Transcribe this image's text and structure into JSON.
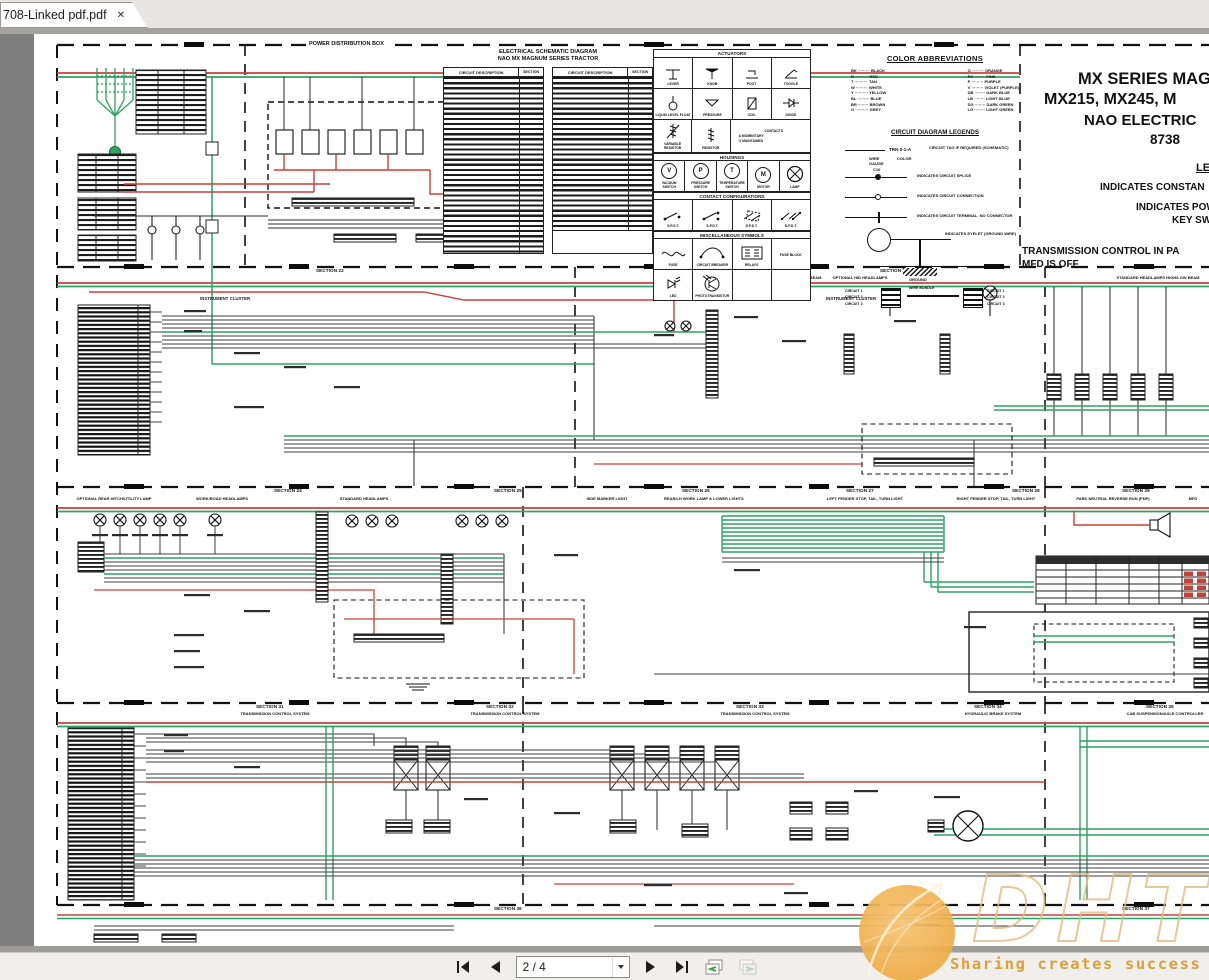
{
  "window": {
    "tab_title": "708-Linked pdf.pdf",
    "close_glyph": "✕"
  },
  "toolbar": {
    "page_display": "2 / 4"
  },
  "watermark": {
    "brand": "DHT",
    "slogan": "Sharing creates success"
  },
  "header_tables": {
    "title1": "ELECTRICAL SCHEMATIC DIAGRAM",
    "title2": "NAO MX MAGNUM SERIES TRACTOR",
    "col_circuit": "CIRCUIT DESCRIPTION",
    "col_section": "SECTION"
  },
  "symbols": {
    "actuators_title": "ACTUATORS",
    "housings_title": "HOUSINGS",
    "contacts_title": "CONTACT CONFIGURATIONS",
    "misc_title": "MISCELLANEOUS SYMBOLS",
    "lever": "LEVER",
    "knob": "KNOB",
    "foot": "FOOT",
    "toggle": "TOGGLE",
    "liquid": "LIQUID LEVEL FLOAT",
    "pressure": "PRESSURE",
    "coil": "COIL",
    "diode": "DIODE",
    "var_resistor": "VARIABLE RESISTOR",
    "resistor": "RESISTOR",
    "contacts_label": "CONTACTS",
    "momentary": "A   MOMENTARY",
    "maintained": "O   MAINTAINED",
    "housing_letters": [
      "V",
      "P",
      "T",
      "M"
    ],
    "vacuum": "VACUUM SWITCH",
    "press_switch": "PRESSURE SWITCH",
    "temp_switch": "TEMPERATURE SWITCH",
    "motor": "MOTOR",
    "lamp": "LAMP",
    "spst": "S.P.S.T.",
    "spdt": "S.P.D.T.",
    "dpst": "D.P.S.T.",
    "dpdt": "D.P.D.T.",
    "fuse": "FUSE",
    "breaker": "CIRCUIT BREAKER",
    "relays": "RELAYS",
    "fuse_block": "FUSE BLOCK",
    "led": "LED",
    "photo": "PHOTOTRANSISTOR"
  },
  "colors": {
    "title": "COLOR ABBREVIATIONS",
    "left": "BK ········· BLACK\nR ·········· RED\nT ·········· TAN\nW ········· WHITE\nY ·········· YELLOW\nBL ········· BLUE\nBR ········ BROWN\nG ·········· GREY",
    "right": "O ········· ORANGE\nPK ········ PINK\nP ········· PURPLE\nV ········· VIOLET (PURPLE)\nDB ········ DARK BLUE\nLB ········ LIGHT BLUE\nDG ········ DARK GREEN\nLG ········ LIGHT GREEN",
    "legends_title": "CIRCUIT DIAGRAM LEGENDS",
    "tag_id": "TRN 0-1-A",
    "tag_wire": "WIRE\nGAUGE",
    "tag_color": "COLOR",
    "tag_note": "CIRCUIT TAG IF REQUIRED (SCHEMATIC)",
    "splice_id": "C10",
    "legend1": "INDICATES CIRCUIT SPLICE",
    "legend2": "INDICATES CIRCUIT CONNECTION",
    "legend3": "INDICATES CIRCUIT TERMINAL, NO CONNECTOR",
    "legend4": "INDICATES EYELET (GROUND WIRE)",
    "ground": "GROUND",
    "conn_left": "CIRCUIT 1\nCIRCUIT 2\nCIRCUIT 3",
    "conn_right": "CIRCUIT 1\nCIRCUIT 2\nCIRCUIT 3",
    "conn_mid": "WIRE BUNDLE"
  },
  "title_block": {
    "l1": "MX SERIES MAG",
    "l2": "MX215, MX245, M",
    "l3": "NAO ELECTRIC",
    "l4": "8738",
    "legend": "LEGE",
    "c1": "INDICATES CONSTAN",
    "c2": "INDICATES POW",
    "c3": "KEY SWI",
    "c4": "TRANSMISSION CONTROL IN PA",
    "c5": "MFD IS OFF"
  },
  "sections": {
    "power_box": "POWER DISTRIBUTION BOX",
    "cluster": "INSTRUMENT CLUSTER",
    "d2": [
      "SECTION 22",
      "SECTION 23"
    ],
    "d2subs": [
      "OPTIONAL FRONT WORK LAMPS",
      "OPTIONAL HEADLAMPS HIGH BEAM",
      "OPTIONAL HID HEADLAMPS",
      "STANDARD HEADLAMPS HIGH/LOW BEAM"
    ],
    "d3": [
      "SECTION 24",
      "SECTION 25",
      "SECTION 26",
      "SECTION 27",
      "SECTION 28",
      "SECTION 29"
    ],
    "d3subs": [
      "OPTIONAL REAR HITCH/UTILITY LAMP",
      "WORK/ROAD HEADLAMPS",
      "STANDARD HEADLAMPS",
      "SIDE MARKER LIGHT",
      "REAR/LH WORK LAMP & LOWER LIGHTS",
      "LEFT FENDER STOP, TAIL, TURN LIGHT",
      "RIGHT FENDER STOP, TAIL, TURN LIGHT",
      "PARK NEUTRAL REVERSE RUN (PNP)",
      "MFD"
    ],
    "d4": [
      {
        "n": "SECTION 31",
        "s": "TRANSMISSION CONTROL SYSTEM"
      },
      {
        "n": "SECTION 32",
        "s": "TRANSMISSION CONTROL SYSTEM"
      },
      {
        "n": "SECTION 33",
        "s": "TRANSMISSION CONTROL SYSTEM"
      },
      {
        "n": "SECTION 34",
        "s": "HYDRAULIC BRAKE SYSTEM"
      },
      {
        "n": "SECTION 35",
        "s": "CAB SUSPENSION/AXLE CONTROLLER"
      }
    ],
    "d5": [
      "SECTION 36",
      "SECTION 37"
    ]
  }
}
